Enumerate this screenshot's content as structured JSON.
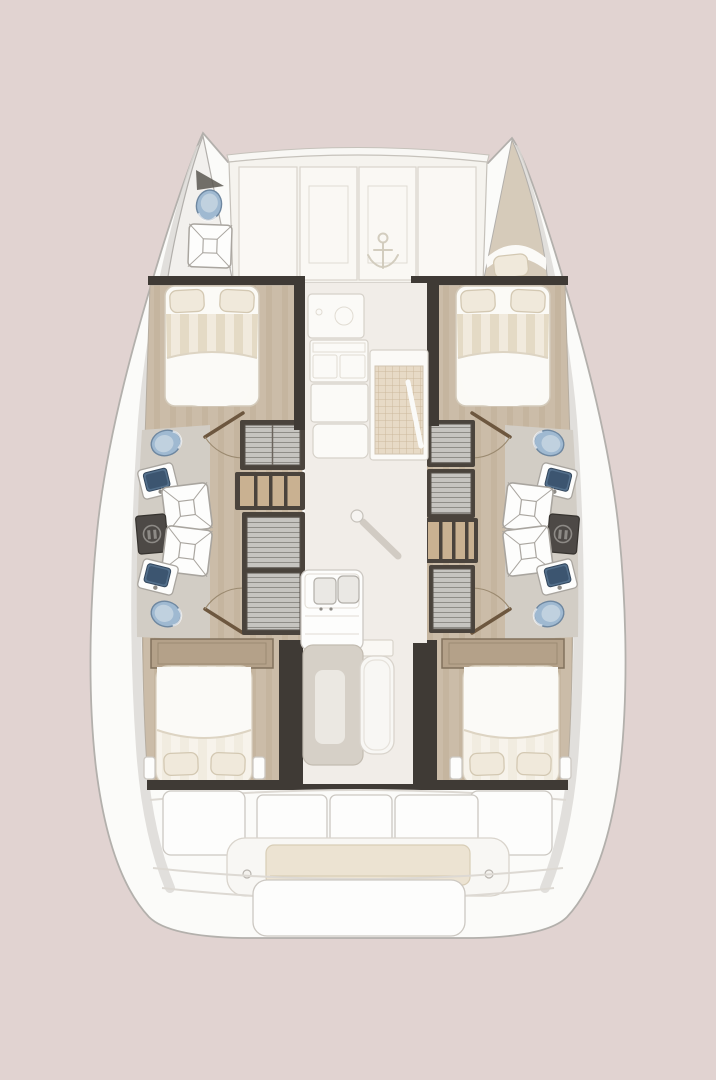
{
  "page": {
    "description": "Catamaran interior deck plan, top-down view, bow at top",
    "view": "top-down",
    "vessel_type": "catamaran"
  },
  "colors": {
    "bg": "#e1d3d1",
    "hullFill": "#fbfbf9",
    "hullStroke": "#b3b0ac",
    "hullShade": "#dbd8d4",
    "deckFill": "#f5f3ee",
    "panelFill": "#faf8f4",
    "panelLine": "#d9d4cb",
    "deckEdge": "#c6c2bb",
    "saloonFloor": "#f1ede8",
    "woodFloor": "#cbbca8",
    "woodStripe": "#bfae97",
    "bathFloor": "#d2cdc5",
    "bowFloor": "#f2f0ed",
    "bowBerthFloor": "#d6cbba",
    "wallDark": "#3f3a35",
    "frameDark": "#4a433c",
    "louverFill": "#c6c4c0",
    "louverLine": "#8f8d88",
    "shelfWood": "#c9b191",
    "bedWhite": "#fbfaf6",
    "bedStripeA": "#f1eadd",
    "bedStripeB": "#e4dac5",
    "pillowFill": "#f0e9db",
    "pillowLine": "#d3c8b2",
    "headboard": "#b4a189",
    "headboardLine": "#81715c",
    "toiletFill": "#9fb9d1",
    "toiletLine": "#6e87a0",
    "toiletInner": "#c0d1df",
    "sinkBasin": "#54708c",
    "sinkInner": "#3c5570",
    "fixtureWhite": "#fdfdfc",
    "fixtureLine": "#a9a59f",
    "utilityFill": "#4d4946",
    "utilityIcon": "#8d8a86",
    "gridBg": "#e7dac6",
    "gridLine": "#ccb99d",
    "tableFill": "#d6d0c7",
    "tableInner": "#ebe8e2",
    "benchFill": "#f8f7f4",
    "benchLine": "#d9d4cc",
    "cushionFill": "#ece3d2",
    "cushionLine": "#d8cdb6",
    "doorLeaf": "#6d573f",
    "doorArc": "#9b8a70",
    "anchorLine": "#d1cabc",
    "postShadow": "#b3aba0"
  },
  "features": {
    "foredeck_hatches": 2,
    "anchor_icon": 1,
    "bow_head": {
      "toilet": 1,
      "shower": 1
    },
    "bow_berth_pillows": 1,
    "double_beds": 4,
    "pillows_total": 9,
    "toilets": 5,
    "bathroom_sinks": 4,
    "showers": 5,
    "utility_lockers": 2,
    "wardrobes": 6,
    "shelf_units": 2,
    "door_swings": 4,
    "galley": {
      "round_sink": 1,
      "stove": 1,
      "double_sink": 1,
      "counters": 3,
      "grid_mat": 1
    },
    "saloon": {
      "mast_post": 1,
      "table": 1,
      "bench": 1
    },
    "cockpit": {
      "stern_lockers": 3,
      "side_seats": 2,
      "bench_cushion": 1
    },
    "swim_platform": 1
  }
}
